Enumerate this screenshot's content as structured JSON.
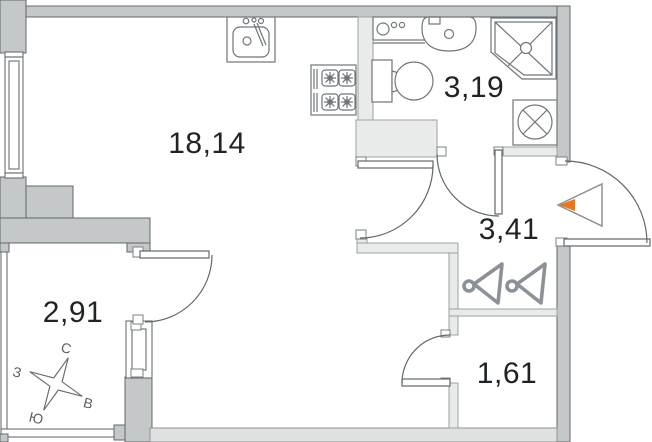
{
  "plan": {
    "rooms": [
      {
        "id": "living-kitchen",
        "area": "18,14"
      },
      {
        "id": "bathroom",
        "area": "3,19"
      },
      {
        "id": "hallway",
        "area": "3,41"
      },
      {
        "id": "balcony",
        "area": "2,91"
      },
      {
        "id": "storage",
        "area": "1,61"
      }
    ],
    "compass": {
      "north": "С",
      "east": "В",
      "south": "Ю",
      "west": "З"
    },
    "colors": {
      "outer_wall": "#c5c8c8",
      "inner_wall": "#e9ebeb",
      "bottom_wall": "#dfe1e1",
      "wall_outline": "#60686a",
      "fixture_line": "#70767a",
      "hanger": "#8b9196",
      "entrance_accent": "#e8761f",
      "label_text": "#1f2326",
      "background": "#ffffff"
    },
    "fixtures": [
      "kitchen-sink",
      "stove",
      "washing-machine",
      "bathroom-sink",
      "toilet",
      "shower-cabin",
      "vent-shaft",
      "wardrobe-hangers",
      "entrance-arrow",
      "compass-rose"
    ]
  }
}
